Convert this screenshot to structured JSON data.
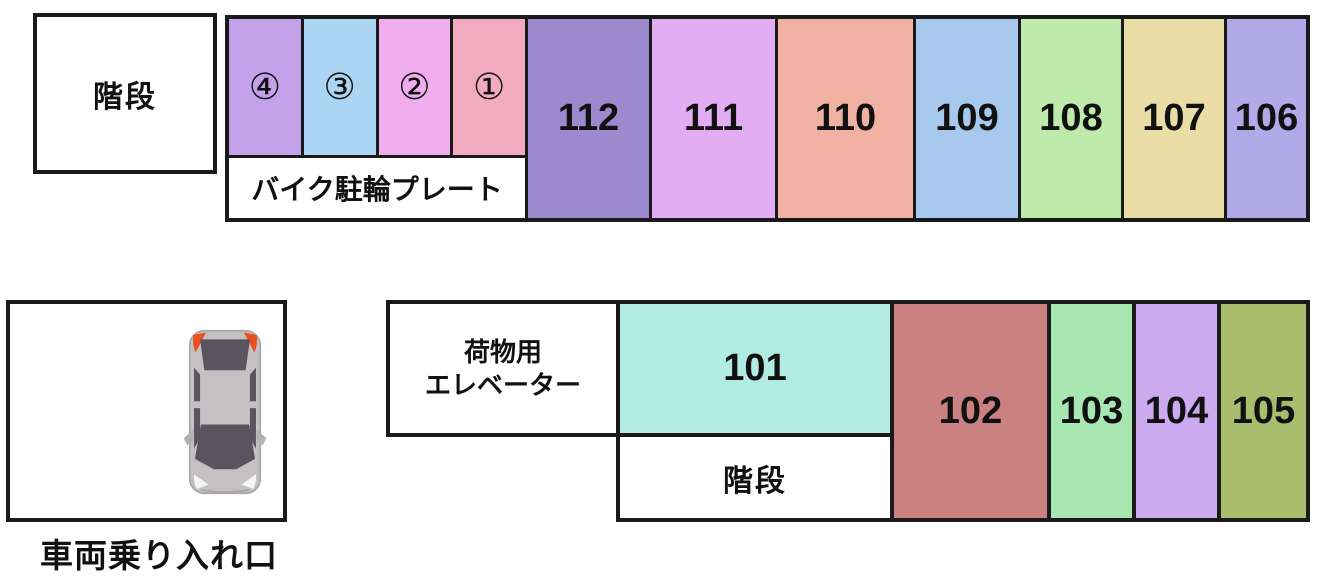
{
  "colors": {
    "border": "#1a1a1a",
    "background": "#ffffff",
    "plate4": "#c3a2e9",
    "plate3": "#abd5f3",
    "plate2": "#f0adee",
    "plate1": "#f2aac0",
    "spot112": "#9d89cd",
    "spot111": "#e2adf3",
    "spot110": "#f1b1a2",
    "spot109": "#a8c9ee",
    "spot108": "#beeaab",
    "spot107": "#eadda6",
    "spot106": "#b2a9e9",
    "spot101": "#b2ebe4",
    "spot102": "#c98281",
    "spot103": "#a8e7b2",
    "spot104": "#cbaaef",
    "spot105": "#a9bd6f",
    "car_body": "#c4c1c3",
    "car_outline": "#a9a6a8",
    "car_glass": "#5a5460",
    "car_taillight": "#ee4f1e",
    "car_mirror": "#b3b0b2",
    "car_headlight": "#f5f5f5"
  },
  "top_row": {
    "stairs_label": "階段",
    "bike_plates": {
      "caption": "バイク駐輪プレート",
      "plates": [
        {
          "label": "④"
        },
        {
          "label": "③"
        },
        {
          "label": "②"
        },
        {
          "label": "①"
        }
      ]
    },
    "spots": [
      {
        "number": "112"
      },
      {
        "number": "111"
      },
      {
        "number": "110"
      },
      {
        "number": "109"
      },
      {
        "number": "108"
      },
      {
        "number": "107"
      },
      {
        "number": "106"
      }
    ]
  },
  "bottom_row": {
    "entrance_label": "車両乗り入れ口",
    "elevator_label_line1": "荷物用",
    "elevator_label_line2": "エレベーター",
    "spot_101": {
      "number": "101"
    },
    "stairs_label": "階段",
    "spots": [
      {
        "number": "102"
      },
      {
        "number": "103"
      },
      {
        "number": "104"
      },
      {
        "number": "105"
      }
    ]
  }
}
